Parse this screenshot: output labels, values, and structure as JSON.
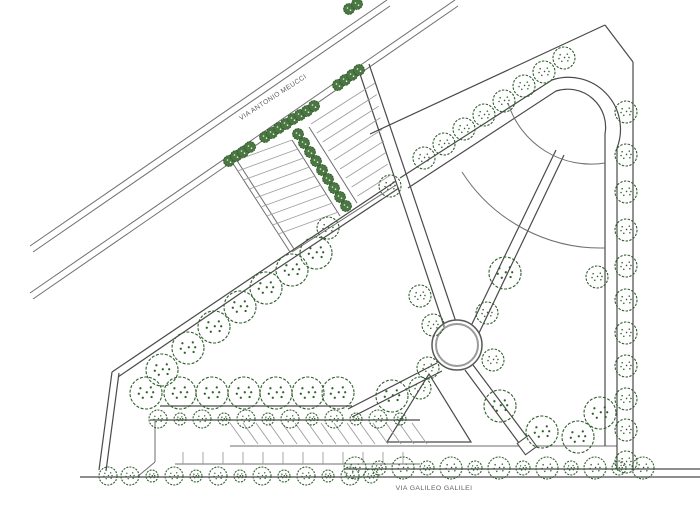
{
  "drawing": {
    "canvas": {
      "w": 700,
      "h": 517,
      "bg": "#ffffff"
    },
    "colors": {
      "line_light": "#6e6e6e",
      "line_dark": "#4a4a4a",
      "hatch": "#9e9e9e",
      "tree_stroke": "#2f5f2c",
      "hedge_fill": "#4b7743",
      "hedge_stroke": "#2b5226",
      "hedge_dot": "#e8f0e4",
      "ring_outer": "#595959",
      "ring_inner": "#9a9a9a",
      "label": "#5f5f5f"
    },
    "street_labels": [
      {
        "text": "VIA ANTONIO MEUCCI",
        "x": 274,
        "y": 99,
        "rotate": -33,
        "size": 6.8
      },
      {
        "text": "VIA GALILEO GALILEI",
        "x": 434,
        "y": 490,
        "rotate": 0,
        "size": 6.8
      }
    ],
    "segments": [
      [
        30,
        246,
        387,
        0,
        "s"
      ],
      [
        33,
        252,
        390,
        6,
        "s"
      ],
      [
        30,
        293,
        455,
        0,
        "s"
      ],
      [
        33,
        299,
        458,
        6,
        "s"
      ],
      [
        112,
        372,
        254,
        276,
        "d"
      ],
      [
        254,
        276,
        396,
        181,
        "d"
      ],
      [
        118,
        377,
        257,
        282,
        "d"
      ],
      [
        257,
        282,
        399,
        188,
        "d"
      ],
      [
        112,
        372,
        99,
        470,
        "d"
      ],
      [
        119,
        373,
        106,
        471,
        "d"
      ],
      [
        292,
        252,
        396,
        185,
        "s"
      ],
      [
        232,
        162,
        290,
        252,
        "s"
      ],
      [
        236,
        159,
        294,
        249,
        "s"
      ],
      [
        292,
        140,
        340,
        216,
        "s"
      ],
      [
        309,
        127,
        357,
        203,
        "s"
      ],
      [
        358,
        68,
        444,
        326,
        "d"
      ],
      [
        369,
        64,
        456,
        322,
        "d"
      ],
      [
        370,
        134,
        605,
        25,
        "d"
      ],
      [
        605,
        25,
        633,
        62,
        "d"
      ],
      [
        633,
        62,
        633,
        470,
        "d"
      ],
      [
        470,
        328,
        556,
        150,
        "d"
      ],
      [
        479,
        333,
        564,
        155,
        "d"
      ],
      [
        437,
        363,
        348,
        409,
        "d"
      ],
      [
        442,
        371,
        352,
        417,
        "d"
      ],
      [
        473,
        365,
        527,
        437,
        "d"
      ],
      [
        465,
        370,
        519,
        443,
        "d"
      ],
      [
        160,
        406,
        352,
        406,
        "d"
      ],
      [
        150,
        420,
        420,
        420,
        "d"
      ],
      [
        230,
        446,
        617,
        446,
        "s"
      ],
      [
        175,
        464,
        420,
        464,
        "s"
      ],
      [
        345,
        469,
        700,
        469,
        "d"
      ],
      [
        80,
        477,
        700,
        477,
        "d"
      ],
      [
        155,
        421,
        155,
        462,
        "s"
      ],
      [
        155,
        462,
        137,
        477,
        "s"
      ]
    ],
    "paths": [
      {
        "d": "M 408,188 L 556,91 A 38 38 0 0 1 605,134 L 605,446",
        "cls": "d"
      },
      {
        "d": "M 400,178 L 552,80 A 52 52 0 0 1 617,148 L 617,469",
        "cls": "d"
      },
      {
        "d": "M 508,103 A 87 87 0 0 0 605,163",
        "cls": "s"
      },
      {
        "d": "M 462,172 A 165 165 0 0 0 605,248",
        "cls": "s"
      },
      {
        "d": "M 429,374 L 387,442 L 471,442 Z",
        "cls": "d"
      }
    ],
    "hatch_groups": [
      {
        "x0": 232,
        "y0": 162,
        "dx": 5.8,
        "dy": 9,
        "ex": 60,
        "ey": -22,
        "exStep": 0,
        "eyStep": 0,
        "n": 9
      },
      {
        "x0": 311,
        "y0": 124,
        "dx": 5.8,
        "dy": 9,
        "ex": 64,
        "ey": -41,
        "exStep": -4,
        "eyStep": 2.6,
        "n": 9
      },
      {
        "x0": 230,
        "y0": 423,
        "dx": 13,
        "dy": 0,
        "ex": 15,
        "ey": 21,
        "exStep": 0,
        "eyStep": 0,
        "n": 15
      },
      {
        "x0": 183,
        "y0": 452,
        "dx": 20,
        "dy": 0,
        "ex": 0,
        "ey": 12,
        "exStep": 0,
        "eyStep": 0,
        "n": 12
      }
    ],
    "plaza_circle": {
      "cx": 457,
      "cy": 345,
      "r_outer": 25,
      "r_inner": 21
    },
    "path_end_square": {
      "cx": 527,
      "cy": 445,
      "size": 14,
      "rot": 54
    },
    "trees": {
      "large": {
        "r": 16,
        "dash": "3 1.6",
        "items": [
          [
            146,
            393
          ],
          [
            180,
            393
          ],
          [
            212,
            393
          ],
          [
            244,
            393
          ],
          [
            276,
            393
          ],
          [
            308,
            393
          ],
          [
            338,
            393
          ],
          [
            162,
            370
          ],
          [
            188,
            348
          ],
          [
            214,
            327
          ],
          [
            240,
            307
          ],
          [
            266,
            288
          ],
          [
            292,
            270
          ],
          [
            316,
            253
          ],
          [
            392,
            396
          ],
          [
            500,
            406
          ],
          [
            542,
            432
          ],
          [
            600,
            413
          ],
          [
            578,
            437
          ],
          [
            505,
            273
          ]
        ]
      },
      "medium": {
        "r": 11,
        "dash": "2.4 1.4",
        "items": [
          [
            424,
            158
          ],
          [
            444,
            144
          ],
          [
            464,
            129
          ],
          [
            484,
            115
          ],
          [
            504,
            101
          ],
          [
            524,
            86
          ],
          [
            544,
            72
          ],
          [
            564,
            58
          ],
          [
            626,
            112
          ],
          [
            626,
            155
          ],
          [
            626,
            192
          ],
          [
            626,
            230
          ],
          [
            626,
            266
          ],
          [
            626,
            300
          ],
          [
            626,
            333
          ],
          [
            626,
            366
          ],
          [
            626,
            399
          ],
          [
            626,
            430
          ],
          [
            626,
            462
          ],
          [
            420,
            296
          ],
          [
            433,
            325
          ],
          [
            428,
            368
          ],
          [
            487,
            313
          ],
          [
            493,
            360
          ],
          [
            597,
            277
          ],
          [
            390,
            186
          ],
          [
            328,
            228
          ],
          [
            420,
            388
          ]
        ]
      },
      "small_row_bottom_right": {
        "r": 9,
        "dash": "2 1.2",
        "items": [
          [
            355,
            468,
            11
          ],
          [
            379,
            468,
            7
          ],
          [
            403,
            468,
            11
          ],
          [
            427,
            468,
            7
          ],
          [
            451,
            468,
            11
          ],
          [
            475,
            468,
            7
          ],
          [
            499,
            468,
            11
          ],
          [
            523,
            468,
            7
          ],
          [
            547,
            468,
            11
          ],
          [
            571,
            468,
            7
          ],
          [
            595,
            468,
            11
          ],
          [
            619,
            468,
            7
          ],
          [
            643,
            468,
            11
          ]
        ]
      },
      "small_row_bottom_left": {
        "r": 9,
        "dash": "2 1.2",
        "items": [
          [
            108,
            476,
            9
          ],
          [
            130,
            476,
            9
          ],
          [
            152,
            476,
            6
          ],
          [
            174,
            476,
            9
          ],
          [
            196,
            476,
            6
          ],
          [
            218,
            476,
            9
          ],
          [
            240,
            476,
            6
          ],
          [
            262,
            476,
            9
          ],
          [
            284,
            476,
            6
          ],
          [
            306,
            476,
            9
          ],
          [
            328,
            476,
            6
          ],
          [
            350,
            476,
            9
          ],
          [
            371,
            476,
            7
          ]
        ]
      },
      "small_row_mid": {
        "r": 9,
        "dash": "2 1.2",
        "items": [
          [
            158,
            419,
            9
          ],
          [
            180,
            419,
            6
          ],
          [
            202,
            419,
            9
          ],
          [
            224,
            419,
            6
          ],
          [
            246,
            419,
            9
          ],
          [
            268,
            419,
            6
          ],
          [
            290,
            419,
            9
          ],
          [
            312,
            419,
            6
          ],
          [
            334,
            419,
            9
          ],
          [
            356,
            419,
            6
          ],
          [
            378,
            419,
            9
          ],
          [
            400,
            419,
            6
          ]
        ]
      }
    },
    "hedges": {
      "r": 5.5,
      "items": [
        [
          229,
          161
        ],
        [
          236,
          156
        ],
        [
          243,
          152
        ],
        [
          250,
          147
        ],
        [
          265,
          137
        ],
        [
          272,
          133
        ],
        [
          279,
          128
        ],
        [
          286,
          124
        ],
        [
          293,
          119
        ],
        [
          300,
          115
        ],
        [
          307,
          111
        ],
        [
          314,
          106
        ],
        [
          338,
          85
        ],
        [
          345,
          80
        ],
        [
          352,
          75
        ],
        [
          359,
          70
        ],
        [
          349,
          9
        ],
        [
          357,
          4
        ],
        [
          298,
          134
        ],
        [
          304,
          143
        ],
        [
          310,
          152
        ],
        [
          316,
          161
        ],
        [
          322,
          170
        ],
        [
          328,
          179
        ],
        [
          334,
          188
        ],
        [
          340,
          197
        ],
        [
          346,
          206
        ]
      ]
    }
  }
}
